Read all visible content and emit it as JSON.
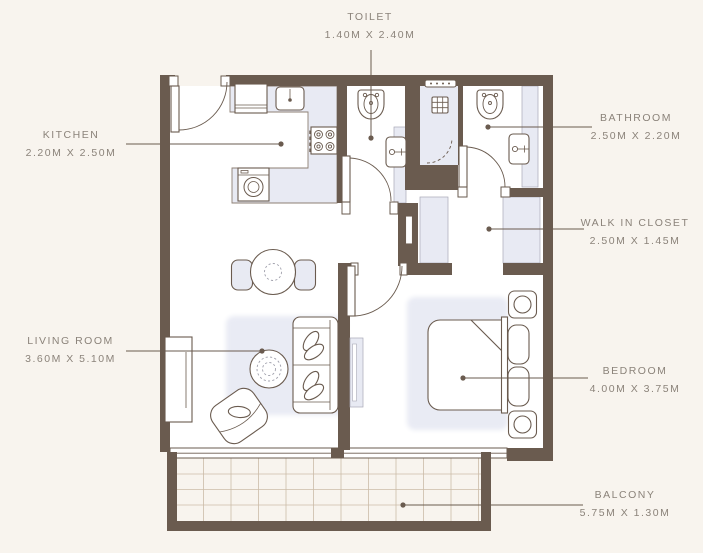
{
  "colors": {
    "background": "#F8F4EE",
    "wall": "#6A5B4F",
    "fixture_light": "#E8EAF3",
    "rug": "#E9EBF4",
    "text": "#8B837A",
    "floor": "#FFFFFF",
    "grid": "#CBBCA8"
  },
  "labels": {
    "toilet": {
      "name": "TOILET",
      "dims": "1.40M X 2.40M"
    },
    "kitchen": {
      "name": "KITCHEN",
      "dims": "2.20M X 2.50M"
    },
    "bathroom": {
      "name": "BATHROOM",
      "dims": "2.50M X 2.20M"
    },
    "walk_in_closet": {
      "name": "WALK IN CLOSET",
      "dims": "2.50M X 1.45M"
    },
    "living_room": {
      "name": "LIVING ROOM",
      "dims": "3.60M X 5.10M"
    },
    "bedroom": {
      "name": "BEDROOM",
      "dims": "4.00M X 3.75M"
    },
    "balcony": {
      "name": "BALCONY",
      "dims": "5.75M X 1.30M"
    }
  }
}
